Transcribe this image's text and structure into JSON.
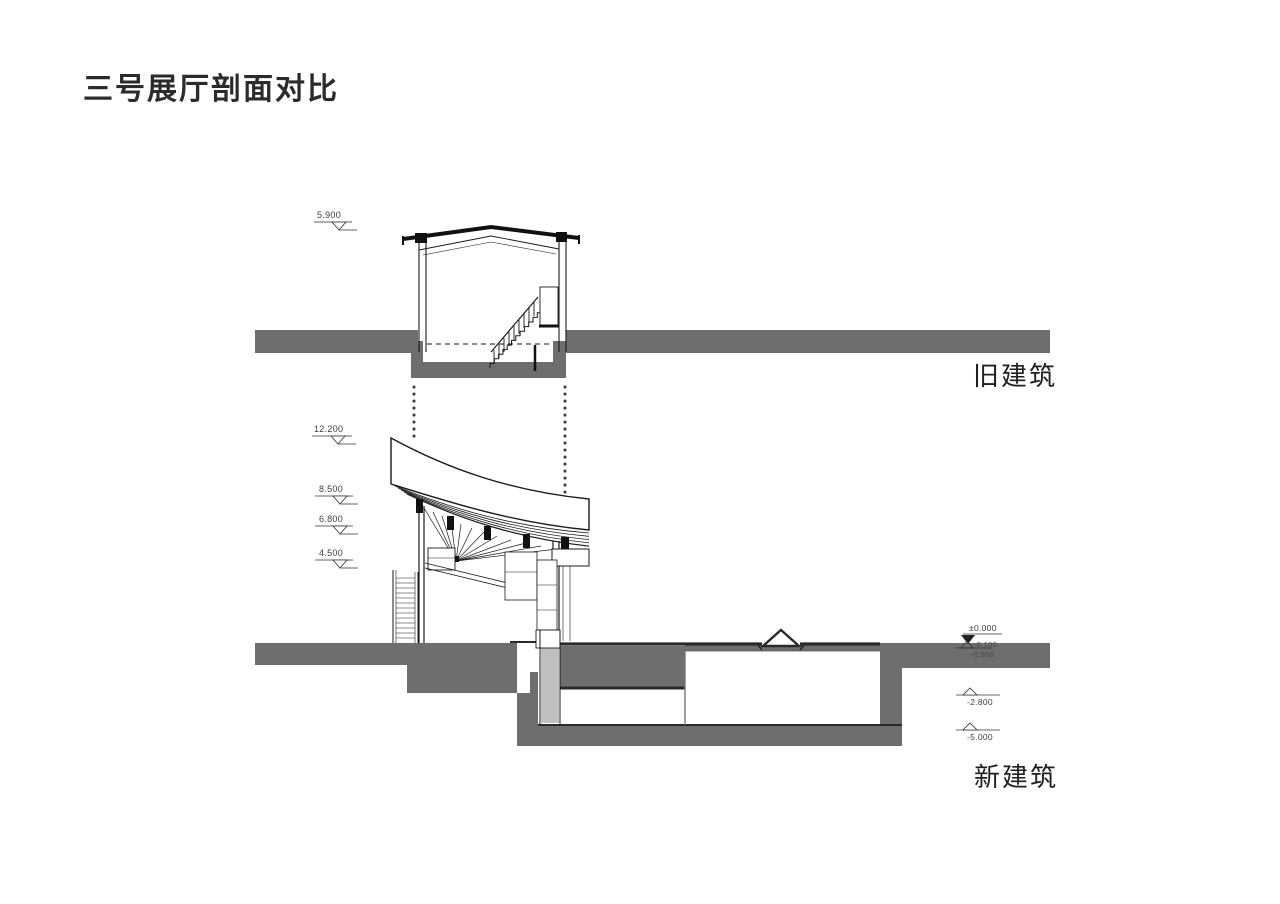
{
  "title": "三号展厅剖面对比",
  "old_section": {
    "label": "旧建筑",
    "levels": {
      "roof": "5.900"
    }
  },
  "new_section": {
    "label": "新建筑",
    "levels_left": [
      "12.200",
      "8.500",
      "6.800",
      "4.500"
    ],
    "levels_right": [
      "±0.000",
      "-0.100",
      "-0.500",
      "-2.800",
      "-5.000"
    ]
  },
  "colors": {
    "earth": "#6e6e6e",
    "line": "#1a1a1a"
  }
}
